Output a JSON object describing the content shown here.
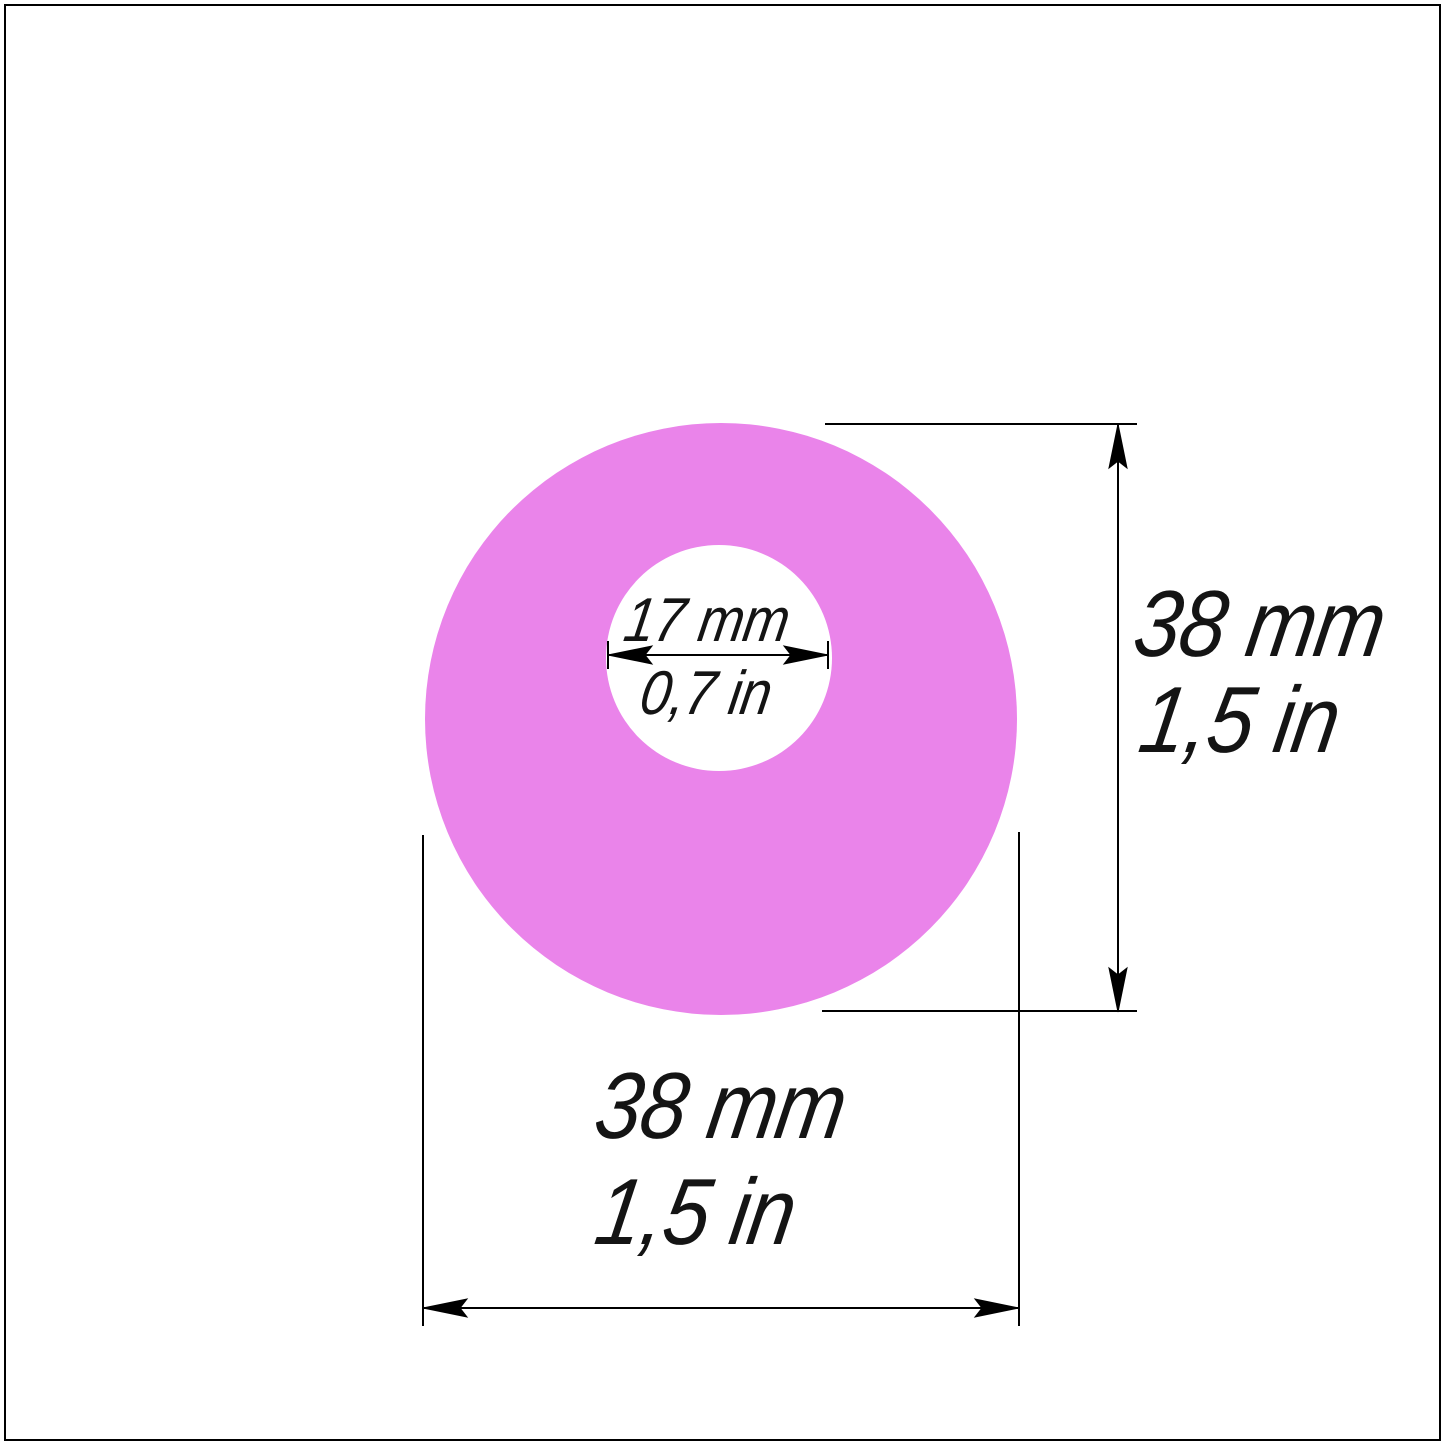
{
  "diagram": {
    "type": "technical-dimension-drawing",
    "inner_diameter": {
      "mm": "17 mm",
      "inch": "0,7 in"
    },
    "outer_diameter_vertical": {
      "mm": "38 mm",
      "inch": "1,5 in"
    },
    "outer_diameter_horizontal": {
      "mm": "38 mm",
      "inch": "1,5 in"
    },
    "values": {
      "outer_diameter_mm": 38,
      "outer_diameter_in": 1.5,
      "inner_diameter_mm": 17,
      "inner_diameter_in": 0.7
    },
    "colors": {
      "ring_fill": "#EA84EA",
      "line_color": "#000000",
      "background": "#FFFFFF"
    }
  }
}
